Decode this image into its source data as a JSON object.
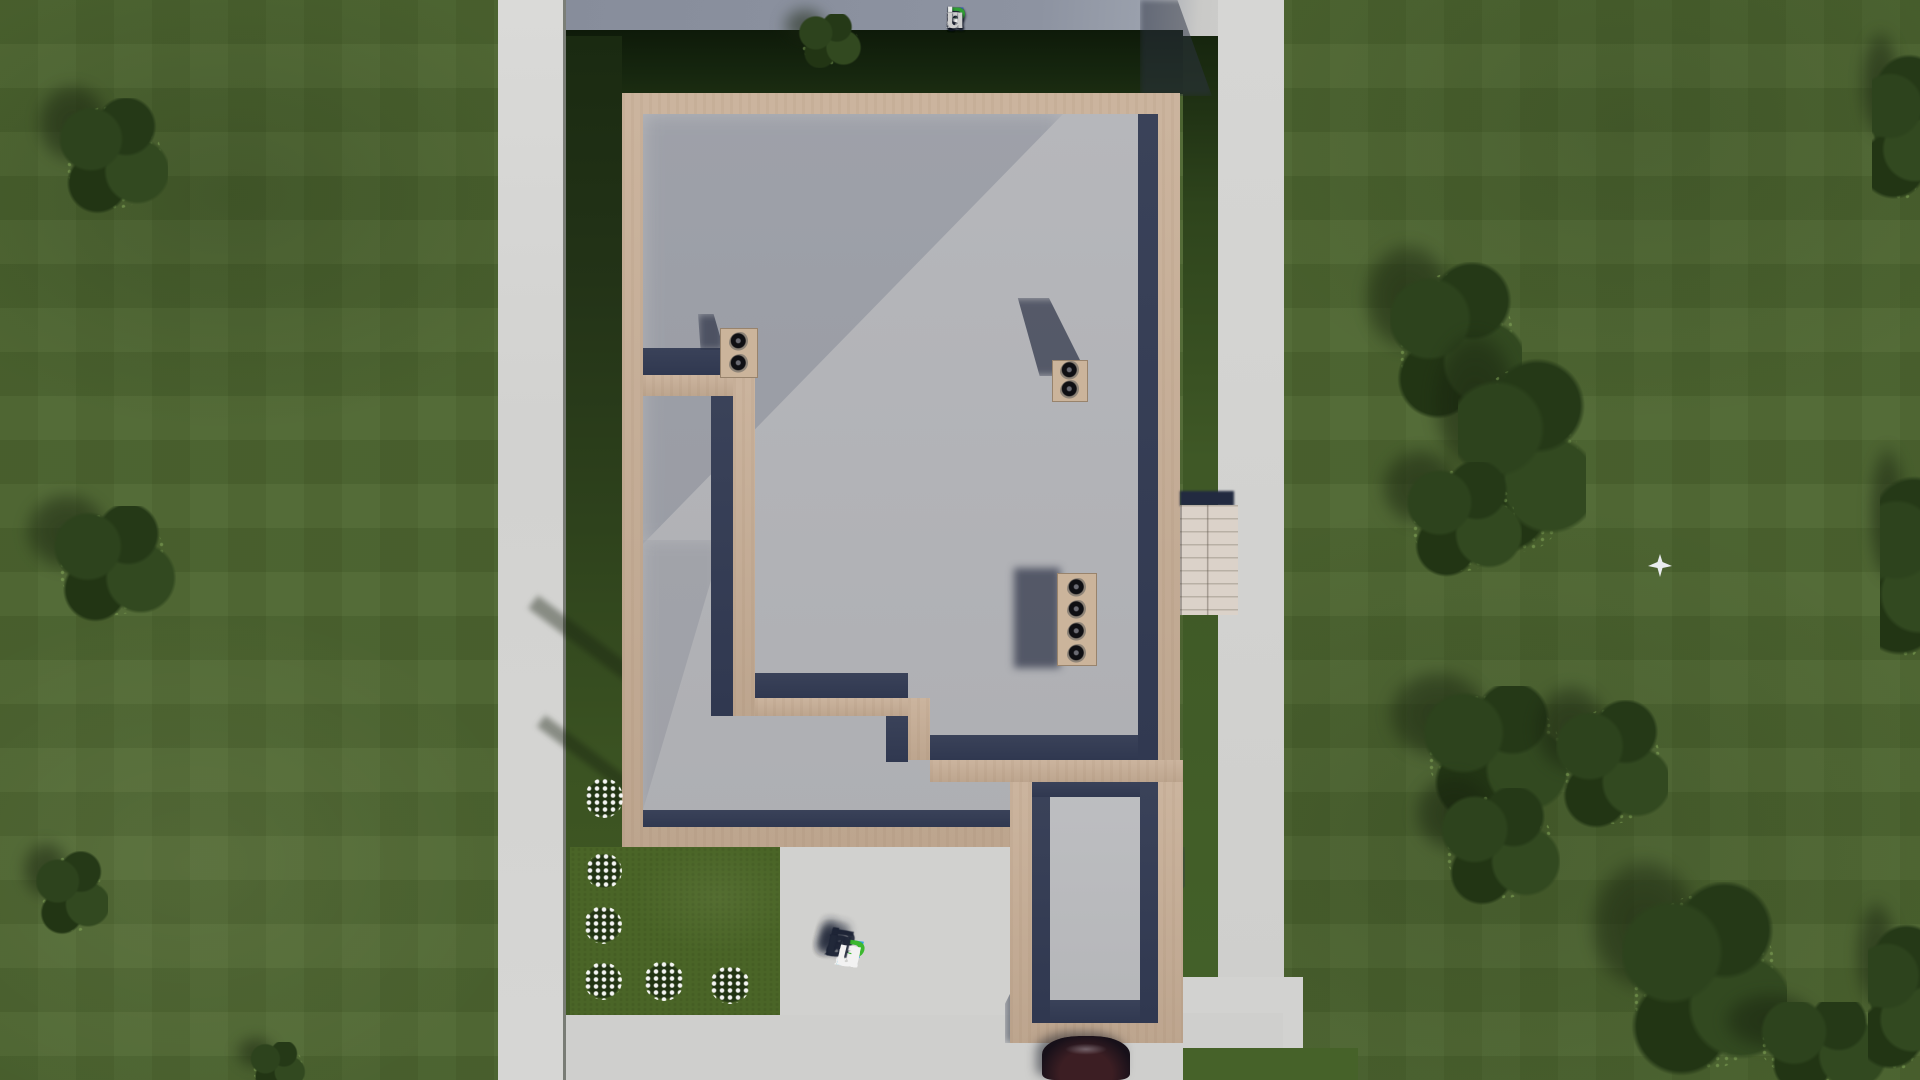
{
  "branding": {
    "site_name": "FixPlans.ru",
    "logo_letters": [
      {
        "ch": "F",
        "color": "#3a66d0"
      },
      {
        "ch": "i",
        "color": "#ececec"
      },
      {
        "ch": "x",
        "color": "#ececec"
      },
      {
        "ch": "P",
        "color": "#2f9e33"
      },
      {
        "ch": "l",
        "color": "#ececec"
      },
      {
        "ch": "a",
        "color": "#ececec"
      },
      {
        "ch": "n",
        "color": "#ececec"
      },
      {
        "ch": "s",
        "color": "#ececec"
      },
      {
        "ch": ".",
        "color": "#2b5fd0"
      },
      {
        "ch": "r",
        "color": "#cfcfcf"
      },
      {
        "ch": "u",
        "color": "#cfcfcf"
      }
    ],
    "watermark_letters": [
      {
        "ch": "F",
        "color": "#2ba1e2"
      },
      {
        "ch": "i",
        "color": "#f2f2f2"
      },
      {
        "ch": "x",
        "color": "#f2f2f2"
      },
      {
        "ch": "P",
        "color": "#3cb82f"
      },
      {
        "ch": "l",
        "color": "#f2f2f2"
      },
      {
        "ch": "a",
        "color": "#f2f2f2"
      },
      {
        "ch": "n",
        "color": "#f2f2f2"
      },
      {
        "ch": "s",
        "color": "#f2f2f2"
      },
      {
        "ch": ".",
        "color": "#2ba1e2"
      },
      {
        "ch": "r",
        "color": "#f2f2f2"
      },
      {
        "ch": "u",
        "color": "#f2f2f2"
      }
    ]
  },
  "scene": {
    "description": "Top-down 3D architectural render of an unfinished house (foundation slab with tan masonry walls, chimney blocks, wood porch and driveway) on a landscaped grass lot with trees, flower bushes and concrete walkways",
    "palette": {
      "grass": "#4d6530",
      "grass_shadow": "#14230d",
      "pavement": "#d2d2d0",
      "pavement_shadowed": "#8d93a1",
      "wall_tan": "#c7ae96",
      "slab_gray": "#b3b4b8",
      "shadow_navy": "#363e55",
      "porch_wood": "#dbd2c9",
      "logo_blue": "#3a66d0",
      "logo_green": "#2f9e33",
      "watermark_blue": "#2ba1e2",
      "watermark_green": "#3cb82f"
    }
  }
}
